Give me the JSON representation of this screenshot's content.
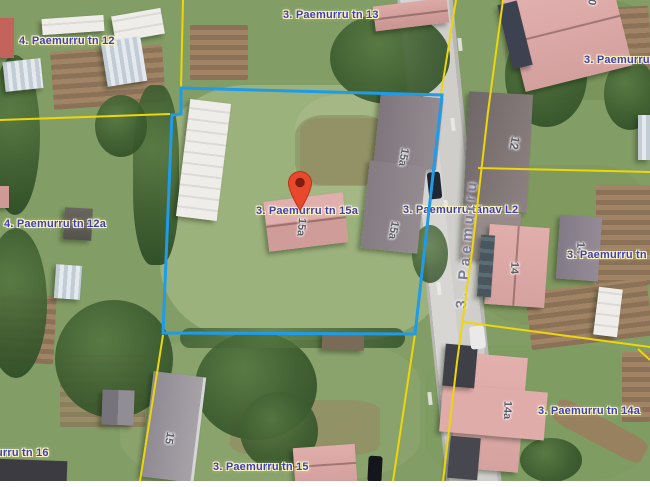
{
  "map_labels": {
    "paemurru_tn_12": "4. Paemurru tn 12",
    "paemurru_tn_13": "3. Paemurru tn 13",
    "paemurru_tn_12_right": "3. Paemurru tn",
    "paemurru_tn_12a": "4. Paemurru tn 12a",
    "paemurru_tn_15a": "3. Paemurru tn 15a",
    "paemurru_tanav_l2": "3. Paemurru tänav L2",
    "paemurru_tn_14": "3. Paemurru tn 14",
    "paemurru_tn_14a": "3. Paemurru tn 14a",
    "paemurru_tn_16": "murru tn 16",
    "paemurru_tn_15": "3. Paemurru tn 15",
    "street_name_vertical": "3. Paemurru"
  },
  "house_numbers": {
    "h10": "10",
    "h12": "12",
    "h14_pink": "14",
    "h14_gray": "14",
    "h14a": "14a",
    "h15": "15",
    "h15a_main": "15a",
    "h15a_upper": "15a",
    "h15a_lower": "15a"
  },
  "marker": {
    "icon": "location-pin-icon"
  },
  "colors": {
    "selected_parcel_boundary": "#1e9ce8",
    "cadastral_line": "#edd60a",
    "label_text": "#3d3dc0",
    "label_halo": "#fdf6bf",
    "pin_fill": "#e8492c",
    "pin_hole": "#7e1d10"
  }
}
